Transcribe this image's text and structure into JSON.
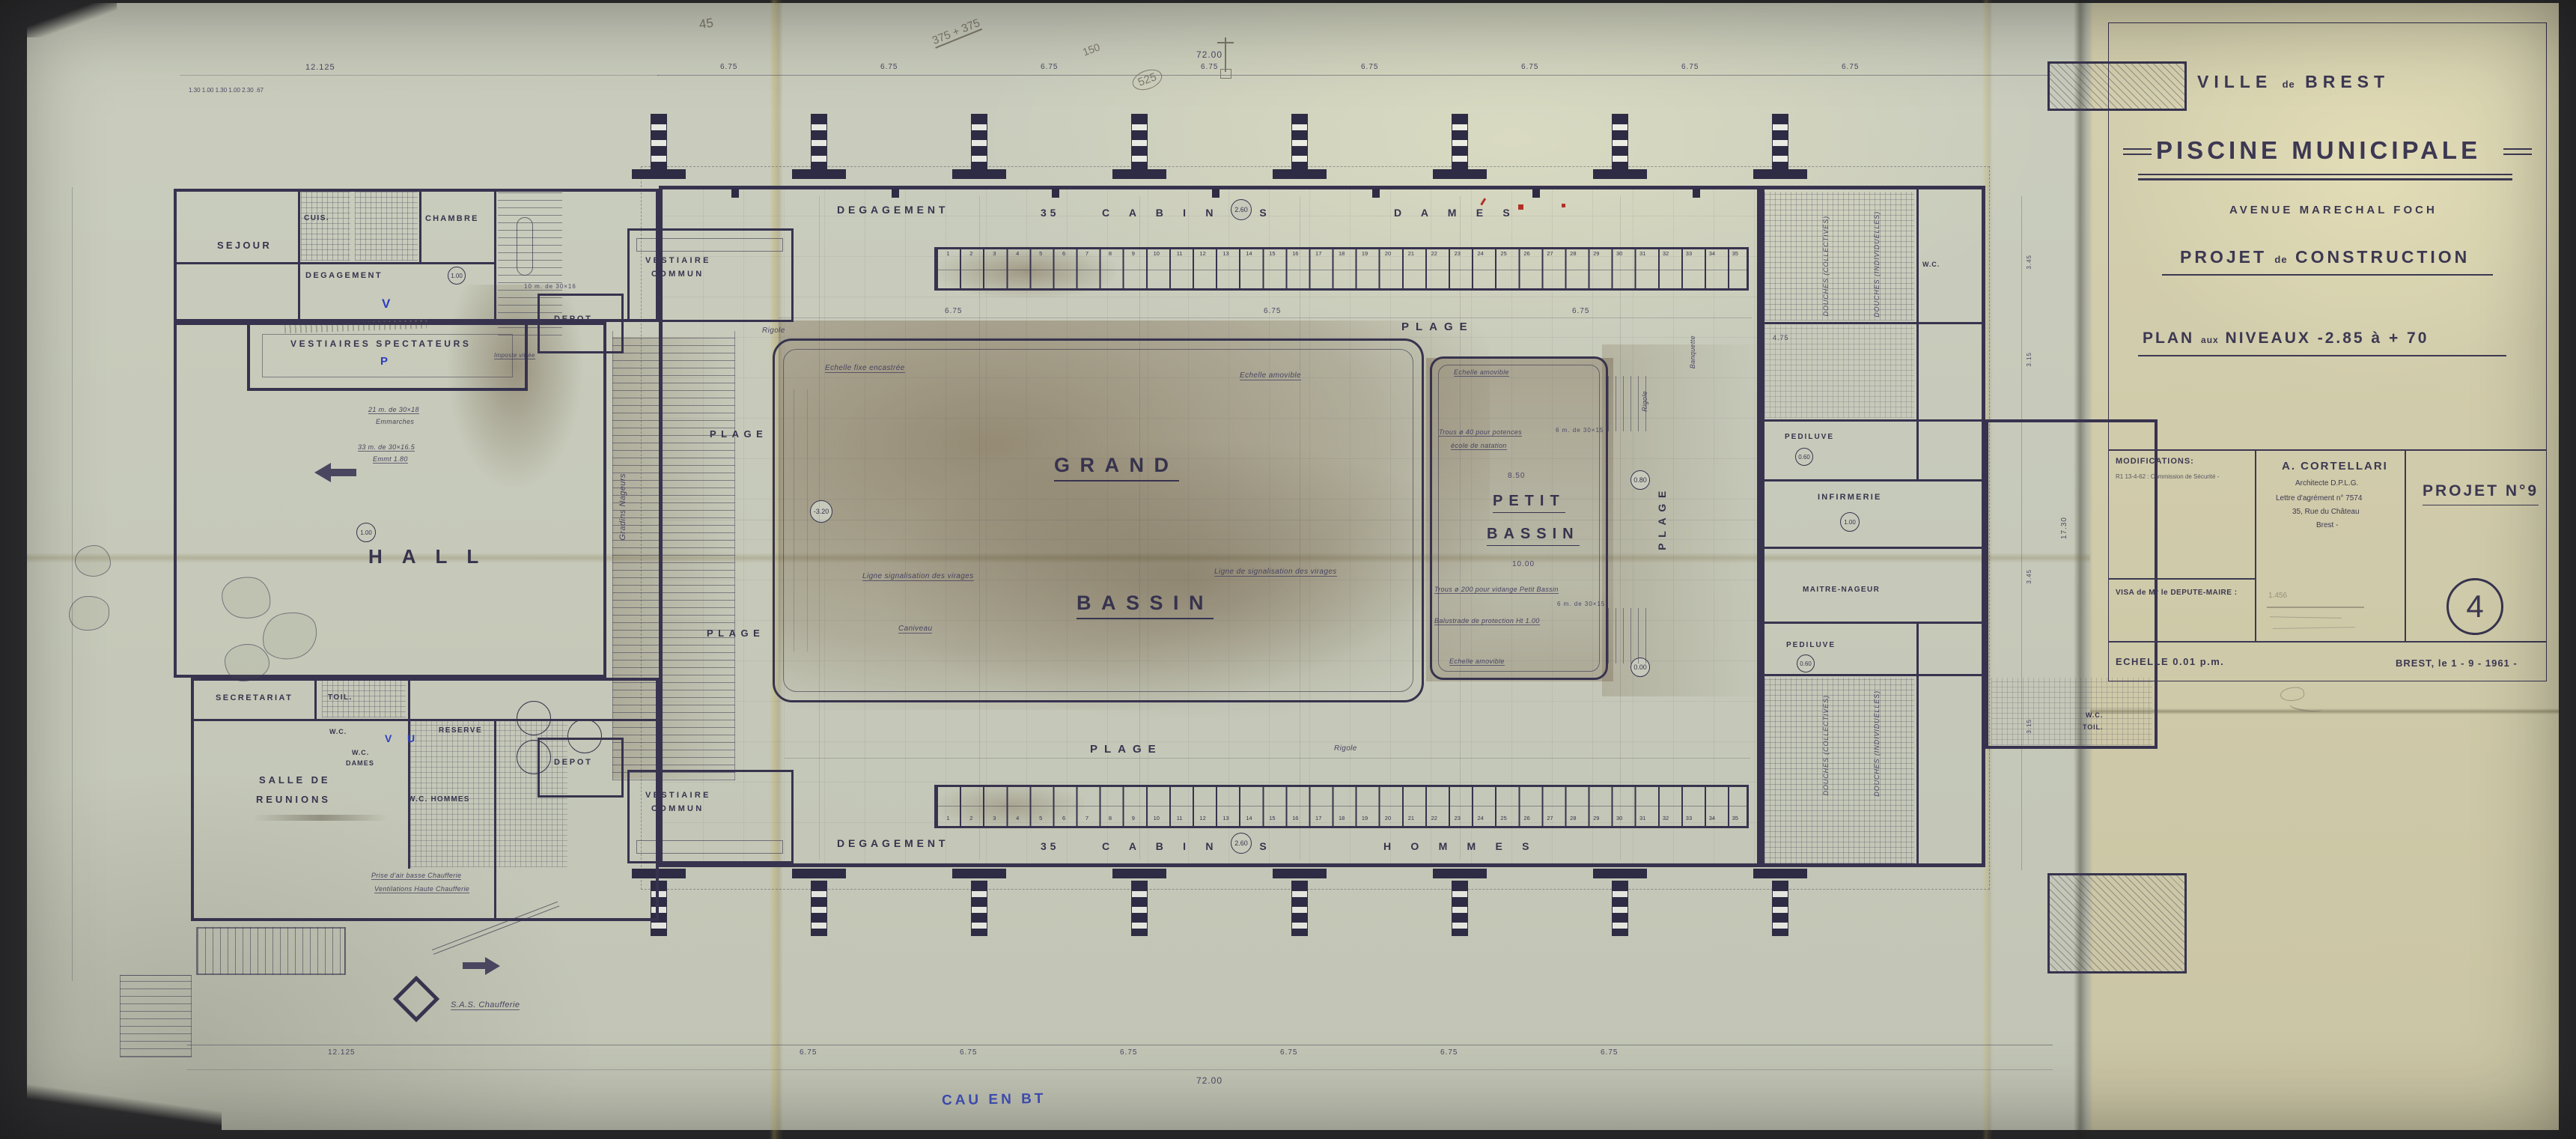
{
  "colors": {
    "ink": "#37334e",
    "paper": "#c7cabb",
    "title_paper": "#d2cdab",
    "stain": "#8a6f4e",
    "blue": "#2c3dc0",
    "red": "#b22f26",
    "pencil": "#7e7a6a"
  },
  "title_block": {
    "ville_1": "VILLE",
    "ville_de": "de",
    "ville_2": "BREST",
    "title": "PISCINE  MUNICIPALE",
    "avenue": "AVENUE  MARECHAL  FOCH",
    "projet_1": "PROJET",
    "projet_de": "de",
    "projet_2": "CONSTRUCTION",
    "plan_1": "PLAN",
    "plan_aux": "aux",
    "plan_2": "NIVEAUX  -2.85 à + 70",
    "modifications": "MODIFICATIONS:",
    "modif_entry": "R1 13-4-62 : Commission de Sécurité -",
    "arch_name": "A. CORTELLARI",
    "arch_title": "Architecte D.P.L.G.",
    "arch_agrement": "Lettre d'agrément n° 7574",
    "arch_addr": "35, Rue du Château",
    "arch_city": "Brest -",
    "projet_no": "PROJET  N°9",
    "visa": "VISA de Mr le DEPUTE-MAIRE :",
    "pencil_sig": "1.456",
    "sheet": "4",
    "echelle": "ECHELLE  0.01 p.m.",
    "date": "BREST, le  1 - 9 - 1961 -"
  },
  "plan": {
    "zones": {
      "degagement": "DEGAGEMENT",
      "cab_count": "35",
      "cab_word": "C A B I N E S",
      "dames": "D A M E S",
      "hommes": "H O M M E S",
      "plage": "PLAGE",
      "rigole": "Rigole",
      "gradins": "Gradins  Nageurs",
      "banquette": "Banquette",
      "hall": "HALL"
    },
    "rooms": {
      "sejour": "SEJOUR",
      "cuis": "CUIS.",
      "chambre": "CHAMBRE",
      "degagement": "DEGAGEMENT",
      "vest_spect": "VESTIAIRES  SPECTATEURS",
      "secretariat": "SECRETARIAT",
      "toil": "TOIL.",
      "wc": "W.C.",
      "wc_dames_1": "W.C.",
      "wc_dames_2": "DAMES",
      "wc_hommes": "W.C. HOMMES",
      "reserve": "RESERVE",
      "salle_1": "SALLE  DE",
      "salle_2": "REUNIONS",
      "depot": "DEPOT",
      "vc1": "VESTIAIRE",
      "vc2": "COMMUN",
      "pediluve": "PEDILUVE",
      "infirmerie": "INFIRMERIE",
      "maitre": "MAITRE-NAGEUR",
      "douches_c": "DOUCHES  (COLLECTIVES)",
      "douches_i": "DOUCHES  (INDIVIDUELLES)",
      "wc_toil_1": "W.C.",
      "wc_toil_2": "TOIL.",
      "grand": "GRAND",
      "petit": "PETIT",
      "bassin": "BASSIN"
    },
    "notes": {
      "echelle_fixe": "Echelle fixe encastrée",
      "echelle_amovible": "Echelle amovible",
      "ligne1": "Ligne signalisation des virages",
      "ligne2": "Ligne de signalisation des virages",
      "caniveau": "Caniveau",
      "trous1": "Trous ø 40 pour potences",
      "trous2": "école de natation",
      "vidange": "Trous ø 200 pour vidange  Petit Bassin",
      "balustrade": "Balustrade de protection  Ht 1.00",
      "six_m": "6 m. de 30×15",
      "imposte": "Imposte vitrée",
      "st1": "21 m. de 30×18",
      "st1b": "Emmarches",
      "st2": "33 m. de 30×16.5",
      "st2b": "Emmt 1.80",
      "st3": "10 m. de 30×16",
      "prise": "Prise d'air basse  Chaufferie",
      "vent": "Ventilations Haute  Chaufferie",
      "sas": "S.A.S.  Chaufferie"
    },
    "levels": {
      "l260": "2.60",
      "l320": "-3.20",
      "l000": "0.00",
      "l080": "0.80",
      "l100": "1.00",
      "l060": "0.60"
    },
    "dims": {
      "total": "72.00",
      "bay": "6.75",
      "left": "12.125",
      "chain": "1.30   1.00   1.30   1.00   2.30   .67",
      "petit_w": "8.50",
      "petit_l": "10.00",
      "v1": "3.45",
      "v2": "3.15",
      "right_total": "17.30",
      "d475": "4.75"
    }
  },
  "annotations": {
    "pencil": {
      "n45": "45",
      "c1": "375 + 375",
      "c2": "150",
      "c3": "525"
    },
    "blue": {
      "v": "V",
      "p": "P",
      "u": "U",
      "note": "CAU EN BT"
    }
  }
}
